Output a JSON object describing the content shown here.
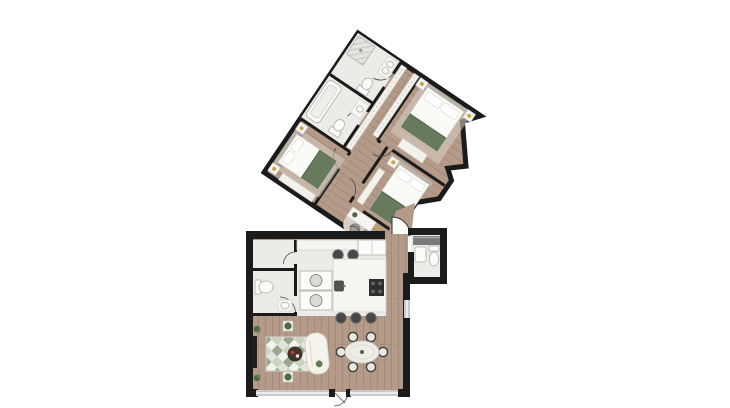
{
  "scene": {
    "background": "#ffffff",
    "description": "2D rendered apartment floor plan, upper bedroom wing rotated ~34 degrees, lower wing with kitchen, living and dining areas"
  },
  "colors": {
    "wall": "#1b1b1b",
    "wood": "#b49a88",
    "wood_seam": "#a18776",
    "tile": "#edebe7",
    "fixture_white": "#fbfbfa",
    "counter": "#f6f5f2",
    "textile_green": "#687a5c",
    "plant_green": "#4d6b42",
    "rug_pale": "#f2f3ef",
    "rug_sage": "#9aa88e",
    "rug_gray": "#ccd3c3",
    "rug_soft": "#e2e5dc",
    "round_rug": "#d9d0c3",
    "sofa": "#f5f3ec",
    "dining_table": "#efede7",
    "chair_dark": "#3f3f3f",
    "appliance_dark": "#2f2f2f",
    "window_glass": "#c9c9c9",
    "coffee_table": "#3f332c",
    "accent_red": "#b33b2e",
    "lamp_gold": "#c8a34c",
    "vanity_gray": "#7a7a7a"
  },
  "elements": {
    "rooms": [
      "bathroom-upper",
      "bathroom-lower",
      "master-bedroom",
      "bedroom-2",
      "bedroom-3",
      "hall-landing",
      "entry-vestibule",
      "guest-bathroom",
      "kitchen",
      "utility-room",
      "wc-laundry",
      "living-room",
      "dining-area"
    ],
    "furniture": [
      "double-bed x3",
      "nightstands with lamps",
      "wardrobes",
      "shower",
      "bathtub",
      "toilets",
      "sinks",
      "desk with chair",
      "round-rug",
      "kitchen-island",
      "cooktop",
      "fridge",
      "bar-stools x5",
      "washer-dryer stack",
      "dining-table with 6 chairs",
      "sofa",
      "coffee-table",
      "diamond-rug",
      "tv-sideboard",
      "potted-plants x4"
    ]
  }
}
